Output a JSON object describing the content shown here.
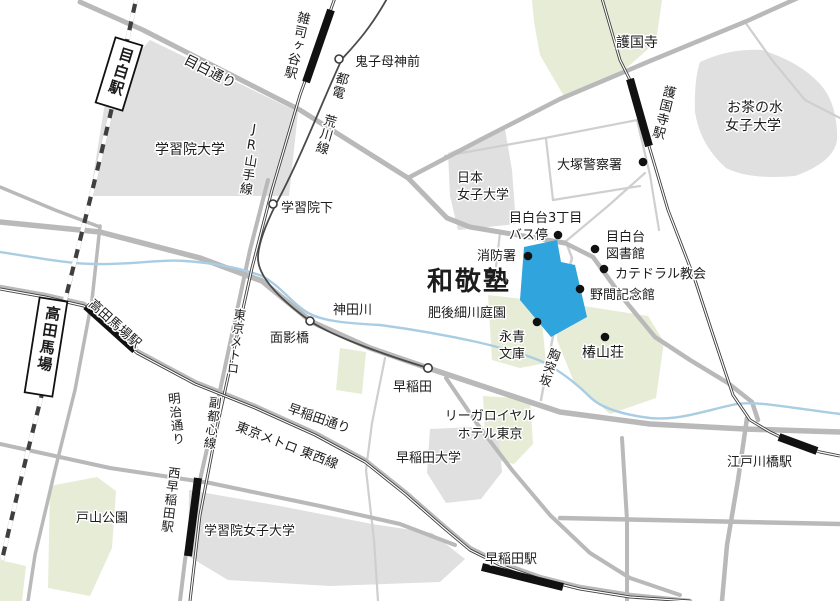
{
  "map": {
    "colors": {
      "highlight_blue": "#2fa4dd",
      "highlight_text_blue": "#29a3de",
      "campus_gray": "#e0e0e0",
      "park_green": "#e7ecd6",
      "road_gray": "#b9b9b9",
      "river_blue": "#a9cde3",
      "rail_black": "#1a1a1a"
    },
    "labels": {
      "mejiro_station": "目白駅",
      "jr_yamanote": "JR山手線",
      "mejiro_dori": "目白通り",
      "zoshigaya_station": "雑司ヶ谷駅",
      "toden_arakawa_line": "都電 荒川線",
      "kishibojinmae_stop": "鬼子母神前",
      "gokokuji_temple": "護国寺",
      "gokokuji_station": "護国寺駅",
      "ochanomizu_univ": [
        "お茶の水",
        "女子大学"
      ],
      "gakushuin_univ": "学習院大学",
      "otsuka_police": "大塚警察署",
      "gakushuinshita_stop": "学習院下",
      "nihon_joshi_univ": [
        "日本",
        "女子大学"
      ],
      "mejirodai_bus_stop": [
        "目白台3丁目",
        "バス停"
      ],
      "mejirodai_library": [
        "目白台",
        "図書館"
      ],
      "fire_station": "消防署",
      "cathedral_church": "カテドラル教会",
      "wakeijuku": "和敬塾",
      "noma_memorial": "野間記念館",
      "higo_hosokawa_garden": "肥後細川庭園",
      "kanda_river": "神田川",
      "eisei_bunko": [
        "永青",
        "文庫"
      ],
      "chinzanso": "椿山荘",
      "munatsukizaka": "胸突坂",
      "omokagebashi_stop": "面影橋",
      "takadanobaba_station": "高田馬場駅",
      "takadanobaba_box": "高田馬場",
      "tokyo_metro": "東京メトロ",
      "fukutoshin_line": "副都心線",
      "meiji_dori": "明治通り",
      "nishiwaseda_station": "西早稲田駅",
      "toyama_park": "戸山公園",
      "gakushuin_womens_univ": "学習院女子大学",
      "waseda_dori": "早稲田通り",
      "tozai_line": "東京メトロ 東西線",
      "waseda_stop": "早稲田",
      "rihga_royal_hotel": [
        "リーガロイヤル",
        "ホテル東京"
      ],
      "waseda_univ": "早稲田大学",
      "waseda_station": "早稲田駅",
      "edogawabashi_station": "江戸川橋駅"
    }
  }
}
